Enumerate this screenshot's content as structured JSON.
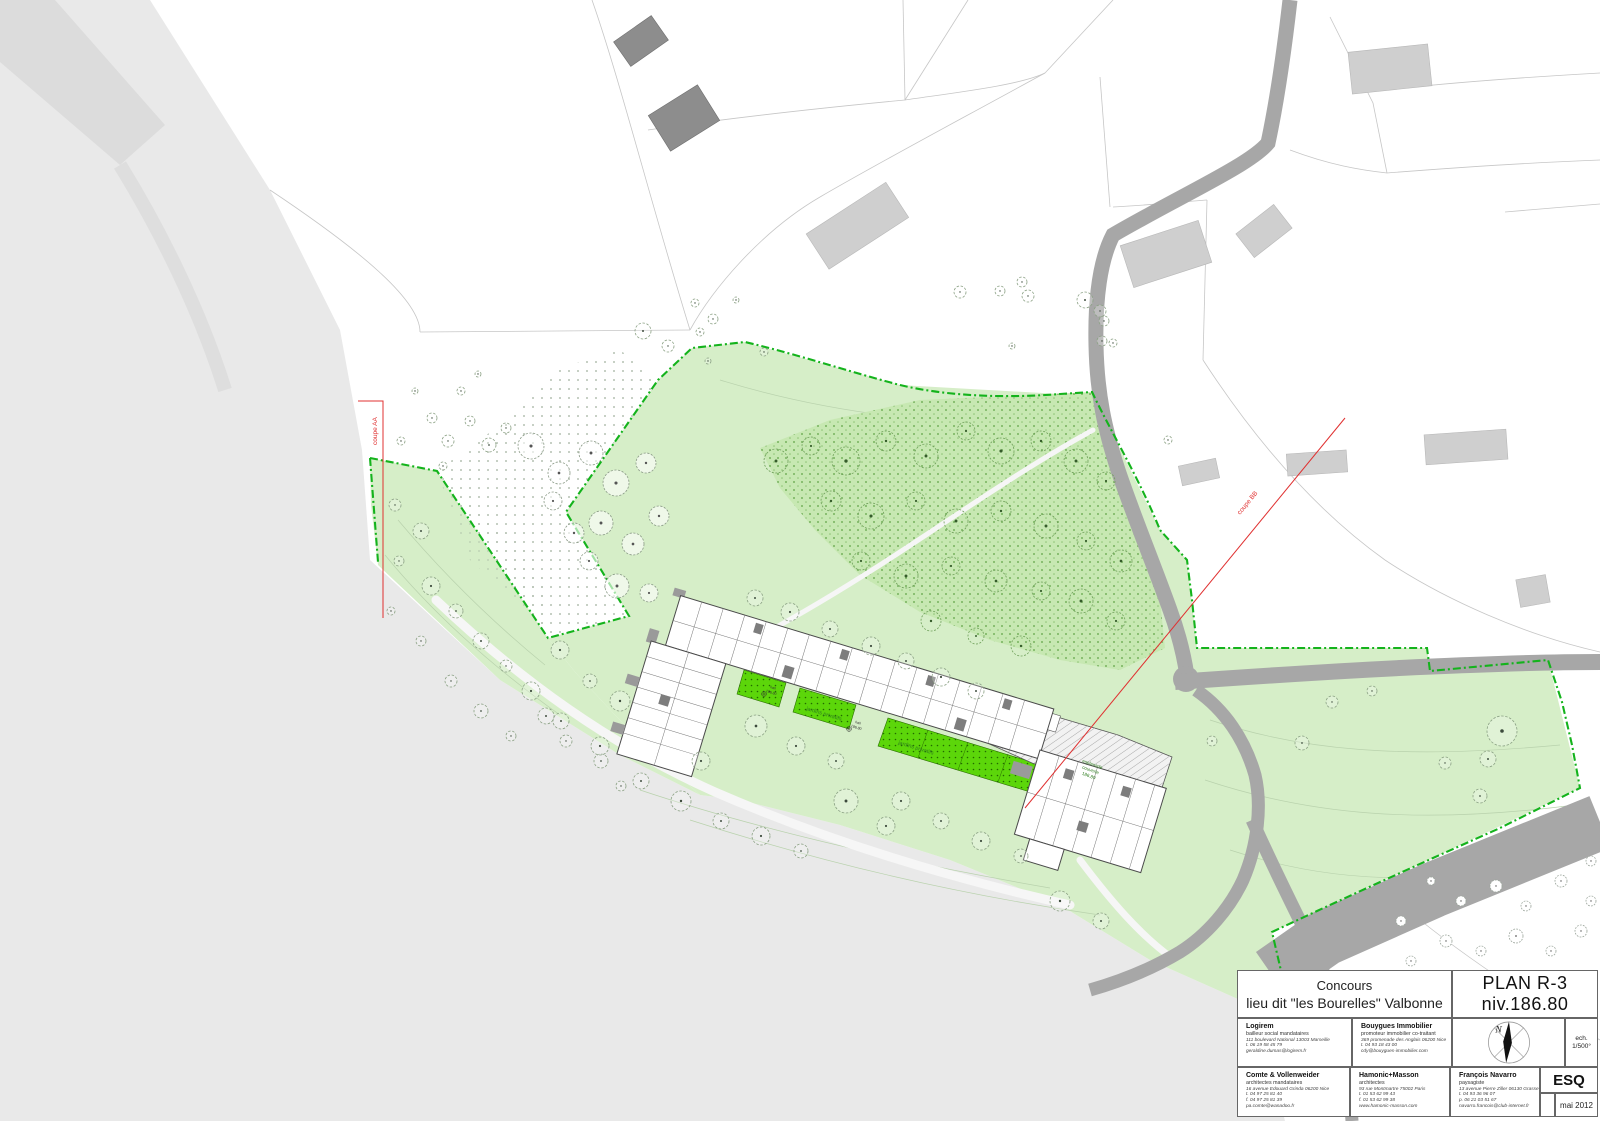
{
  "title_block": {
    "competition_line1": "Concours",
    "competition_line2": "lieu dit \"les Bourelles\"  Valbonne",
    "plan_title": "PLAN R-3  niv.186.80",
    "scale_label": "ech.",
    "scale_value": "1/500°",
    "phase": "ESQ",
    "date": "mai 2012",
    "north_letter": "N",
    "contacts": [
      {
        "name": "Logirem",
        "role": "bailleur social mandataires",
        "lines": [
          "111 boulevard National 13003 Marseille",
          "t. 06 19 58 45 79",
          "geraldine.dumas@logirem.fr"
        ]
      },
      {
        "name": "Bouygues Immobilier",
        "role": "promoteur immobilier co-traitant",
        "lines": [
          "369 promenade des Anglais 06200 Nice",
          "t. 04 93 18 43 00",
          "cdy@bouygues-immobilier.com"
        ]
      },
      {
        "name": "Comte & Vollenweider",
        "role": "architectes mandataires",
        "lines": [
          "16 avenue Edouard Grinda  06200 Nice",
          "t. 04 97 25 81 40",
          "f. 04 97 25 81 39",
          "pa.comte@wanadoo.fr"
        ]
      },
      {
        "name": "Hamonic+Masson",
        "role": "architectes",
        "lines": [
          "93 rue Montmartre 75002 Paris",
          "t. 01 53 62 99 43",
          "f. 01 53 62 99 38",
          "www.hamonic-masson.com"
        ]
      },
      {
        "name": "François Navarro",
        "role": "paysagiste",
        "lines": [
          "13 avenue Pierre Ziller 06130 Grasse",
          "t. 04 93 36 96 07",
          "p. 06 21 03 51 67",
          "navarro.francois@club-internet.fr"
        ]
      }
    ]
  },
  "plan": {
    "section_aa": "coupe AA",
    "section_bb": "coupe BB",
    "gardens_label": "jardins privatifs",
    "hall_label": "hall",
    "hall_level": "186.80",
    "esplanade_l1": "esplanade",
    "esplanade_l2": "couverte",
    "esplanade_l3": "186.80",
    "parking_l1": "parkings",
    "parking_l2": "stationnements couverts",
    "parking_l3": "sur terre"
  },
  "colors": {
    "site_green": "#d6eec8",
    "woodland_green": "#c7e8b2",
    "garden_bright_green": "#5cd60a",
    "boundary_green": "#14b31c",
    "road_gray": "#a7a7a7",
    "terrain_gray": "#e9e9e9",
    "section_red": "#e03030"
  },
  "map": {
    "trees": {
      "outlined": [
        [
          432,
          418,
          5
        ],
        [
          448,
          441,
          6
        ],
        [
          470,
          421,
          5
        ],
        [
          489,
          445,
          7
        ],
        [
          506,
          428,
          5
        ],
        [
          443,
          466,
          4
        ],
        [
          415,
          391,
          3
        ],
        [
          401,
          441,
          4
        ],
        [
          461,
          391,
          4
        ],
        [
          478,
          374,
          3
        ],
        [
          695,
          303,
          4
        ],
        [
          713,
          319,
          5
        ],
        [
          736,
          300,
          3
        ],
        [
          764,
          352,
          4
        ],
        [
          708,
          361,
          3
        ],
        [
          643,
          331,
          8
        ],
        [
          668,
          346,
          6
        ],
        [
          700,
          332,
          4
        ],
        [
          960,
          292,
          6
        ],
        [
          1000,
          291,
          5
        ],
        [
          1085,
          300,
          8
        ],
        [
          1012,
          346,
          3
        ],
        [
          1022,
          282,
          5
        ],
        [
          1028,
          296,
          6
        ],
        [
          1100,
          311,
          6
        ],
        [
          1104,
          321,
          5
        ],
        [
          1102,
          341,
          5
        ],
        [
          1113,
          343,
          4
        ],
        [
          1168,
          440,
          4
        ],
        [
          395,
          505,
          6
        ],
        [
          421,
          531,
          8
        ],
        [
          399,
          561,
          5
        ],
        [
          431,
          586,
          9
        ],
        [
          456,
          611,
          7
        ],
        [
          481,
          641,
          8
        ],
        [
          506,
          666,
          6
        ],
        [
          531,
          691,
          9
        ],
        [
          421,
          641,
          5
        ],
        [
          391,
          611,
          4
        ],
        [
          451,
          681,
          6
        ],
        [
          481,
          711,
          7
        ],
        [
          511,
          736,
          5
        ],
        [
          546,
          716,
          8
        ],
        [
          566,
          741,
          6
        ],
        [
          601,
          761,
          7
        ],
        [
          621,
          786,
          5
        ],
        [
          560,
          650,
          9
        ],
        [
          590,
          681,
          7
        ],
        [
          620,
          701,
          10
        ],
        [
          561,
          721,
          8
        ],
        [
          600,
          746,
          9
        ],
        [
          641,
          781,
          8
        ],
        [
          681,
          801,
          10
        ],
        [
          721,
          821,
          8
        ],
        [
          761,
          836,
          9
        ],
        [
          801,
          851,
          7
        ],
        [
          756,
          726,
          11
        ],
        [
          796,
          746,
          9
        ],
        [
          836,
          761,
          8
        ],
        [
          901,
          801,
          9
        ],
        [
          941,
          821,
          8
        ],
        [
          981,
          841,
          9
        ],
        [
          1021,
          856,
          7
        ],
        [
          846,
          801,
          12
        ],
        [
          886,
          826,
          9
        ],
        [
          701,
          761,
          9
        ],
        [
          755,
          598,
          8
        ],
        [
          790,
          612,
          9
        ],
        [
          830,
          629,
          8
        ],
        [
          871,
          646,
          9
        ],
        [
          906,
          661,
          8
        ],
        [
          941,
          677,
          9
        ],
        [
          976,
          691,
          8
        ],
        [
          1332,
          702,
          6
        ],
        [
          1502,
          731,
          15
        ],
        [
          1488,
          759,
          8
        ],
        [
          1445,
          763,
          6
        ],
        [
          1302,
          743,
          7
        ],
        [
          1480,
          796,
          7
        ],
        [
          1212,
          741,
          5
        ],
        [
          1372,
          691,
          5
        ],
        [
          1060,
          901,
          10
        ],
        [
          1101,
          921,
          8
        ]
      ],
      "woodland": [
        [
          776,
          461,
          12
        ],
        [
          811,
          446,
          9
        ],
        [
          846,
          461,
          14
        ],
        [
          886,
          441,
          10
        ],
        [
          926,
          456,
          12
        ],
        [
          966,
          431,
          9
        ],
        [
          1001,
          451,
          13
        ],
        [
          1041,
          441,
          10
        ],
        [
          1076,
          461,
          12
        ],
        [
          1106,
          481,
          9
        ],
        [
          831,
          501,
          10
        ],
        [
          871,
          516,
          13
        ],
        [
          916,
          501,
          9
        ],
        [
          956,
          521,
          12
        ],
        [
          1001,
          511,
          10
        ],
        [
          1046,
          526,
          12
        ],
        [
          1086,
          541,
          9
        ],
        [
          1121,
          561,
          11
        ],
        [
          861,
          561,
          9
        ],
        [
          906,
          576,
          12
        ],
        [
          951,
          566,
          9
        ],
        [
          996,
          581,
          11
        ],
        [
          1041,
          591,
          9
        ],
        [
          1081,
          601,
          12
        ],
        [
          1116,
          621,
          9
        ],
        [
          931,
          621,
          10
        ],
        [
          976,
          636,
          8
        ],
        [
          1021,
          646,
          10
        ]
      ],
      "olive": [
        [
          531,
          446,
          13
        ],
        [
          559,
          473,
          11
        ],
        [
          591,
          453,
          12
        ],
        [
          616,
          483,
          13
        ],
        [
          646,
          463,
          10
        ],
        [
          601,
          523,
          12
        ],
        [
          633,
          544,
          11
        ],
        [
          659,
          516,
          10
        ],
        [
          589,
          561,
          9
        ],
        [
          617,
          586,
          12
        ],
        [
          649,
          593,
          9
        ],
        [
          553,
          501,
          9
        ],
        [
          574,
          533,
          10
        ]
      ],
      "grove": [
        [
          1391,
          1061,
          6
        ],
        [
          1421,
          1041,
          8
        ],
        [
          1451,
          1071,
          5
        ],
        [
          1471,
          1051,
          9
        ],
        [
          1501,
          1081,
          6
        ],
        [
          1521,
          1056,
          7
        ],
        [
          1546,
          1076,
          5
        ],
        [
          1566,
          1051,
          8
        ],
        [
          1586,
          1081,
          5
        ],
        [
          1441,
          1001,
          6
        ],
        [
          1471,
          986,
          5
        ],
        [
          1501,
          1006,
          8
        ],
        [
          1531,
          991,
          6
        ],
        [
          1561,
          1011,
          5
        ],
        [
          1586,
          996,
          7
        ],
        [
          1411,
          961,
          5
        ],
        [
          1446,
          941,
          6
        ],
        [
          1481,
          951,
          5
        ],
        [
          1516,
          936,
          7
        ],
        [
          1551,
          951,
          5
        ],
        [
          1581,
          931,
          6
        ],
        [
          1461,
          901,
          5
        ],
        [
          1496,
          886,
          6
        ],
        [
          1526,
          906,
          5
        ],
        [
          1561,
          881,
          6
        ],
        [
          1591,
          901,
          5
        ],
        [
          1431,
          881,
          4
        ],
        [
          1401,
          921,
          5
        ],
        [
          1591,
          861,
          5
        ],
        [
          1571,
          1106,
          6
        ],
        [
          1531,
          1111,
          5
        ]
      ]
    }
  }
}
